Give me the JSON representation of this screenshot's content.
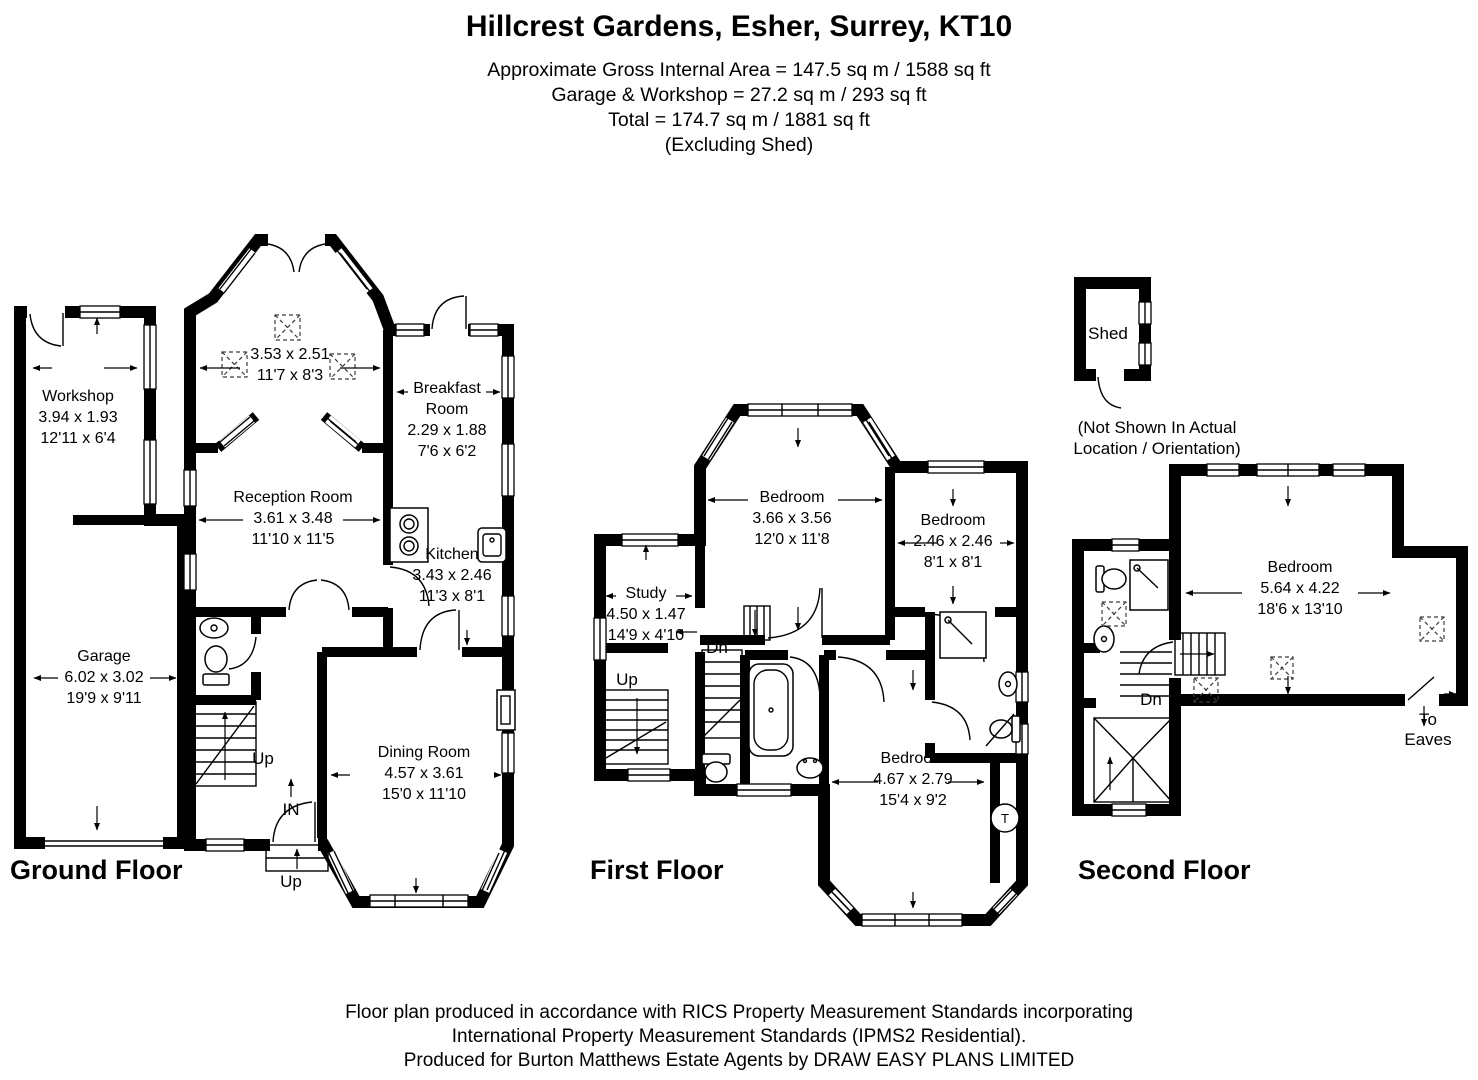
{
  "colors": {
    "ink": "#000000",
    "paper": "#ffffff"
  },
  "header": {
    "title": "Hillcrest Gardens, Esher, Surrey, KT10",
    "area_line1": "Approximate Gross Internal Area = 147.5 sq m / 1588 sq ft",
    "area_line2": "Garage & Workshop = 27.2 sq m / 293 sq ft",
    "area_line3": "Total = 174.7 sq m / 1881 sq ft",
    "area_line4": "(Excluding Shed)"
  },
  "ground_floor": {
    "title": "Ground Floor",
    "rooms": {
      "workshop": {
        "name": "Workshop",
        "metric": "3.94 x 1.93",
        "imperial": "12'11 x 6'4"
      },
      "garage": {
        "name": "Garage",
        "metric": "6.02 x 3.02",
        "imperial": "19'9 x 9'11"
      },
      "front_room": {
        "metric": "3.53 x 2.51",
        "imperial": "11'7 x 8'3"
      },
      "breakfast_room": {
        "name": "Breakfast Room",
        "metric": "2.29 x 1.88",
        "imperial": "7'6 x 6'2"
      },
      "reception_room": {
        "name": "Reception Room",
        "metric": "3.61 x 3.48",
        "imperial": "11'10 x 11'5"
      },
      "kitchen": {
        "name": "Kitchen",
        "metric": "3.43 x 2.46",
        "imperial": "11'3 x 8'1"
      },
      "dining_room": {
        "name": "Dining Room",
        "metric": "4.57 x 3.61",
        "imperial": "15'0 x 11'10"
      }
    },
    "labels": {
      "stairs_up": "Up",
      "entrance_in": "IN",
      "porch_up": "Up"
    }
  },
  "first_floor": {
    "title": "First Floor",
    "rooms": {
      "bedroom_front": {
        "name": "Bedroom",
        "metric": "3.66 x 3.56",
        "imperial": "12'0 x 11'8"
      },
      "bedroom_middle": {
        "name": "Bedroom",
        "metric": "2.46 x 2.46",
        "imperial": "8'1 x 8'1"
      },
      "study": {
        "name": "Study",
        "metric": "4.50 x 1.47",
        "imperial": "14'9 x 4'10"
      },
      "bedroom_back": {
        "name": "Bedroom",
        "metric": "4.67 x 2.79",
        "imperial": "15'4 x 9'2"
      }
    },
    "labels": {
      "stairs_dn": "Dn",
      "stairs_up": "Up",
      "water_tank": "T"
    }
  },
  "second_floor": {
    "title": "Second Floor",
    "rooms": {
      "bedroom": {
        "name": "Bedroom",
        "metric": "5.64 x 4.22",
        "imperial": "18'6 x 13'10"
      }
    },
    "shed": {
      "name": "Shed",
      "note_line1": "(Not Shown In Actual",
      "note_line2": "Location / Orientation)"
    },
    "labels": {
      "stairs_dn": "Dn",
      "to_eaves": "To Eaves"
    }
  },
  "footer": {
    "line1": "Floor plan produced in accordance with RICS Property Measurement Standards incorporating",
    "line2": "International Property Measurement Standards (IPMS2 Residential).",
    "line3": "Produced for Burton Matthews Estate Agents by DRAW EASY PLANS LIMITED"
  }
}
